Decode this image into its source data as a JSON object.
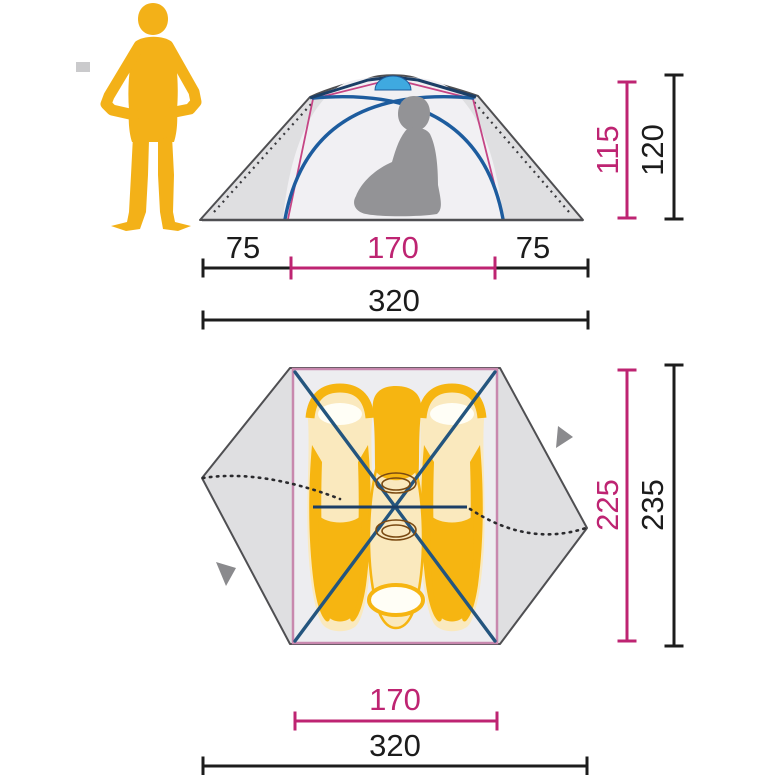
{
  "diagram": {
    "type": "tent-dimension-diagram",
    "front_view": {
      "inner_height": "115",
      "outer_height": "120",
      "left_vestibule_width": "75",
      "inner_width": "170",
      "right_vestibule_width": "75",
      "total_width": "320"
    },
    "floor_plan": {
      "inner_depth": "225",
      "outer_depth": "235",
      "inner_width": "170",
      "total_width": "320"
    },
    "colors": {
      "scale_person_yellow": "#f3b118",
      "sleeping_bag_gold": "#f6b511",
      "sleeping_bag_cream": "#fae9be",
      "pillow_white": "#fffef6",
      "tent_fly_grey": "#dfdfe1",
      "tent_outline_grey": "#4f4f52",
      "inner_tent_fill": "#efeef2",
      "inner_border_pink": "#c888ae",
      "pole_blue": "#1d5c9e",
      "vent_light_blue": "#3fa9e0",
      "dimension_magenta": "#be2472",
      "dimension_black": "#1c1c1c",
      "person_silhouette_grey": "#939396",
      "arrow_grey": "#8a8a8d"
    }
  }
}
